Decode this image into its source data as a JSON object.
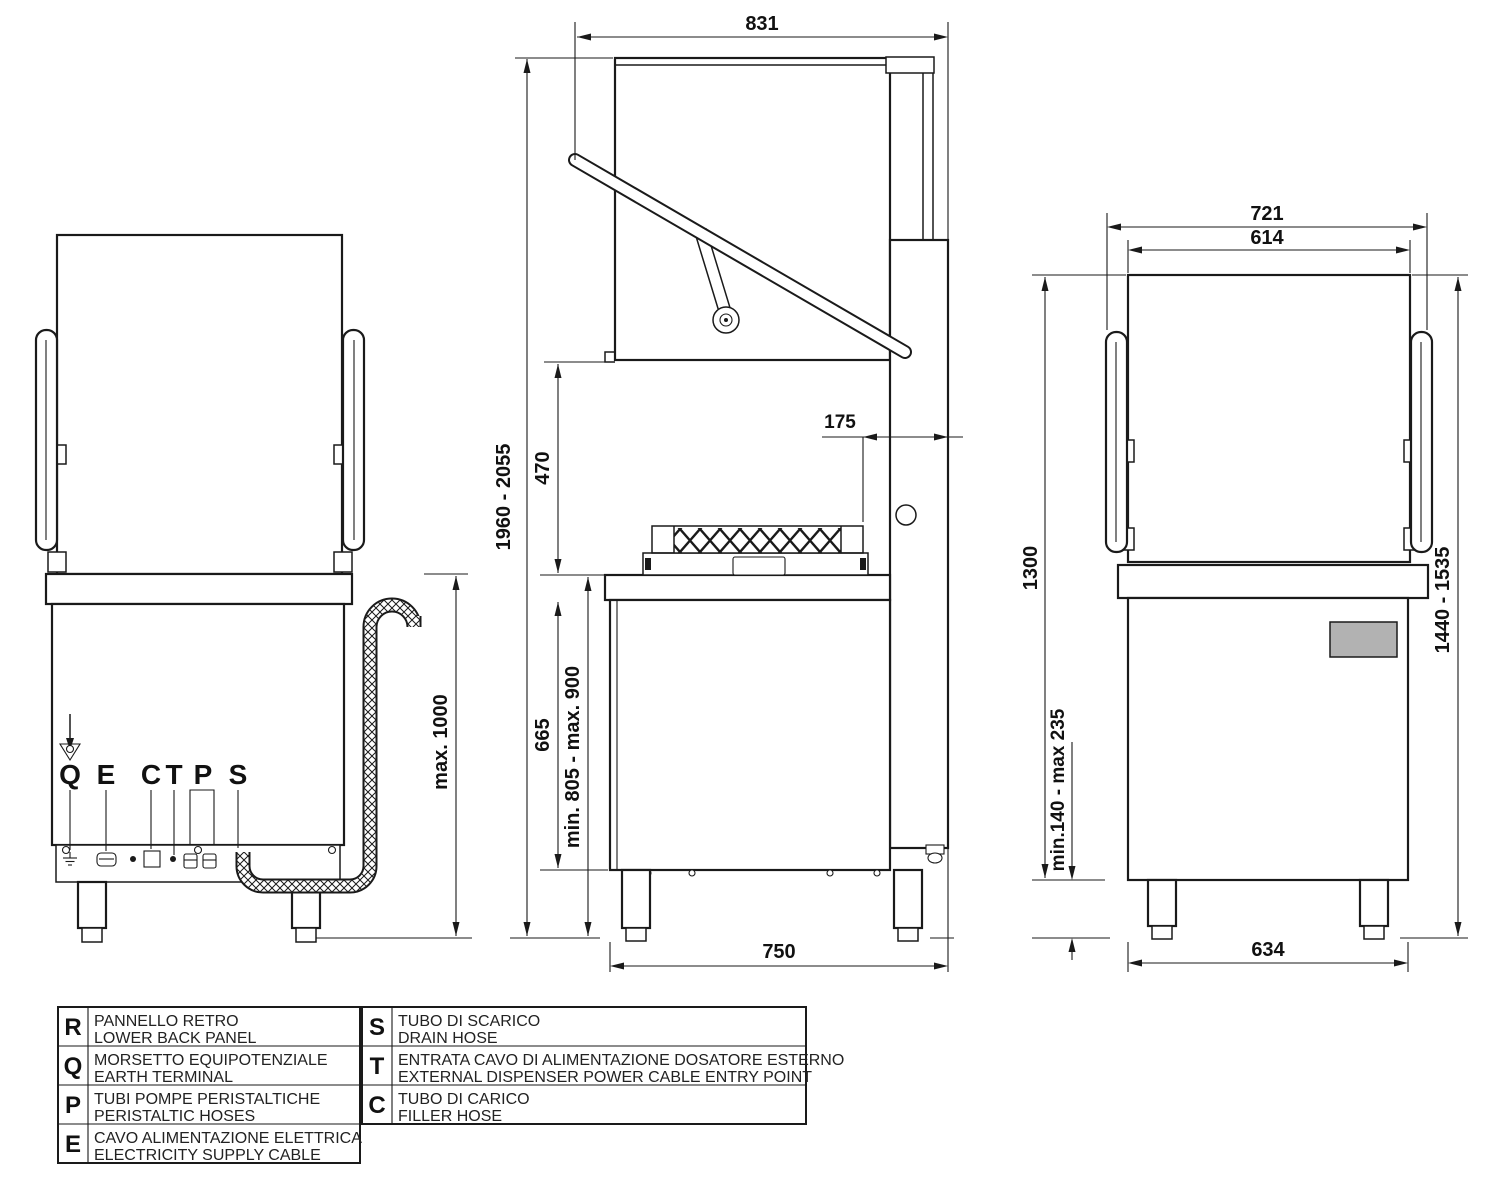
{
  "back_view": {
    "callouts": [
      "Q",
      "E",
      "C",
      "T",
      "P",
      "S"
    ],
    "drain_max_height": "max. 1000"
  },
  "side_view": {
    "depth_total": "831",
    "height_total": "1960 - 2055",
    "hood_lift": "470",
    "base_front_height": "665",
    "worktop_height": "min. 805 - max. 900",
    "back_clearance": "175",
    "base_depth": "750"
  },
  "front_view": {
    "worktop_width": "721",
    "hood_width": "614",
    "body_height": "1300",
    "overall_height": "1440 - 1535",
    "leg_height": "min.140 - max 235",
    "base_width": "634"
  },
  "legend": {
    "left": [
      {
        "key": "R",
        "line1": "PANNELLO RETRO",
        "line2": "LOWER BACK PANEL"
      },
      {
        "key": "Q",
        "line1": "MORSETTO EQUIPOTENZIALE",
        "line2": "EARTH TERMINAL"
      },
      {
        "key": "P",
        "line1": "TUBI POMPE PERISTALTICHE",
        "line2": "PERISTALTIC HOSES"
      },
      {
        "key": "E",
        "line1": "CAVO ALIMENTAZIONE ELETTRICA",
        "line2": "ELECTRICITY SUPPLY CABLE"
      }
    ],
    "right": [
      {
        "key": "S",
        "line1": "TUBO DI SCARICO",
        "line2": "DRAIN HOSE"
      },
      {
        "key": "T",
        "line1": "ENTRATA CAVO DI ALIMENTAZIONE DOSATORE ESTERNO",
        "line2": "EXTERNAL DISPENSER POWER CABLE ENTRY POINT"
      },
      {
        "key": "C",
        "line1": "TUBO DI CARICO",
        "line2": "FILLER HOSE"
      }
    ]
  }
}
